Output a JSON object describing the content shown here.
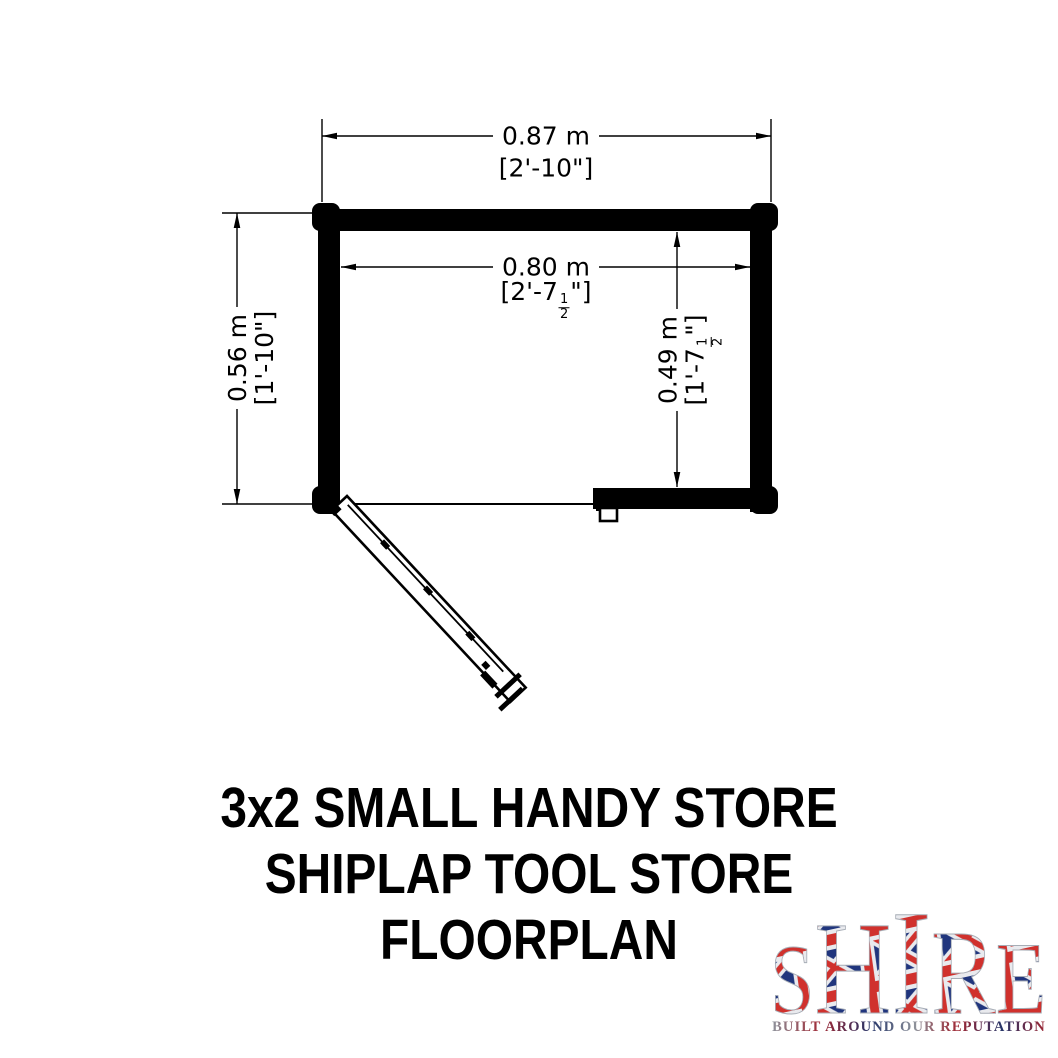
{
  "page": {
    "background": "#ffffff",
    "line_color": "#000000",
    "wall_color": "#000000"
  },
  "floorplan": {
    "dim_width_outer": {
      "metric": "0.87 m",
      "imperial": "[2'-10\"]"
    },
    "dim_width_inner": {
      "metric": "0.80 m",
      "imperial_pre": "[2'-7",
      "frac_num": "1",
      "frac_den": "2",
      "imperial_post": "\"]"
    },
    "dim_height_outer": {
      "metric": "0.56 m",
      "imperial": "[1'-10\"]"
    },
    "dim_height_inner": {
      "metric": "0.49 m",
      "imperial_pre": "[1'-7",
      "frac_num": "1",
      "frac_den": "2",
      "imperial_post": "\"]"
    }
  },
  "title": {
    "line1": "3x2 SMALL HANDY STORE",
    "line2": "SHIPLAP TOOL STORE",
    "line3": "FLOORPLAN"
  },
  "logo": {
    "letters": [
      "S",
      "H",
      "I",
      "R",
      "E"
    ],
    "tagline": "BUILT AROUND OUR REPUTATION",
    "flag_blue": "#20357d",
    "flag_red": "#d0312d",
    "flag_white": "#e9eaee",
    "tagline_navy": "#253468",
    "tagline_red": "#a02733",
    "tagline_grey": "#8d929b"
  }
}
